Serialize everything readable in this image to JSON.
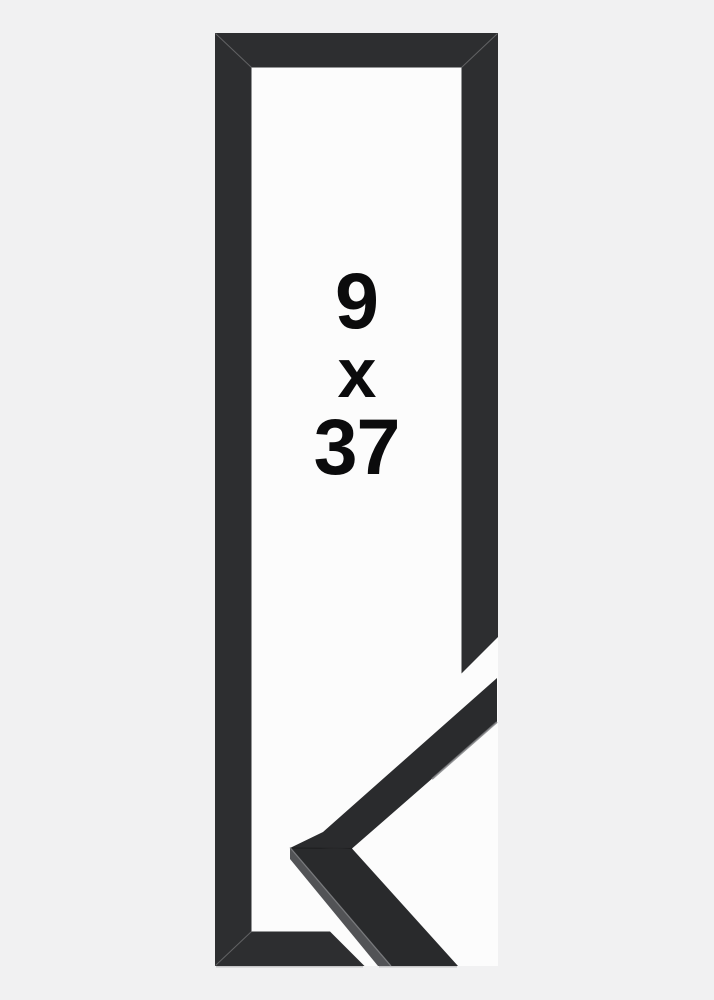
{
  "size_label": {
    "width": "9",
    "separator": "x",
    "height": "37"
  },
  "colors": {
    "bg": "#f1f1f2",
    "interior": "#fcfcfc",
    "frame": "#2d2e30",
    "detail-face": "#2a2b2d",
    "detail-face-lower": "#292a2c",
    "detail-side": "#525356",
    "text": "#0b0b0c",
    "hairline": "#bcbcbe",
    "edge-highlight": "#7d7e81"
  }
}
